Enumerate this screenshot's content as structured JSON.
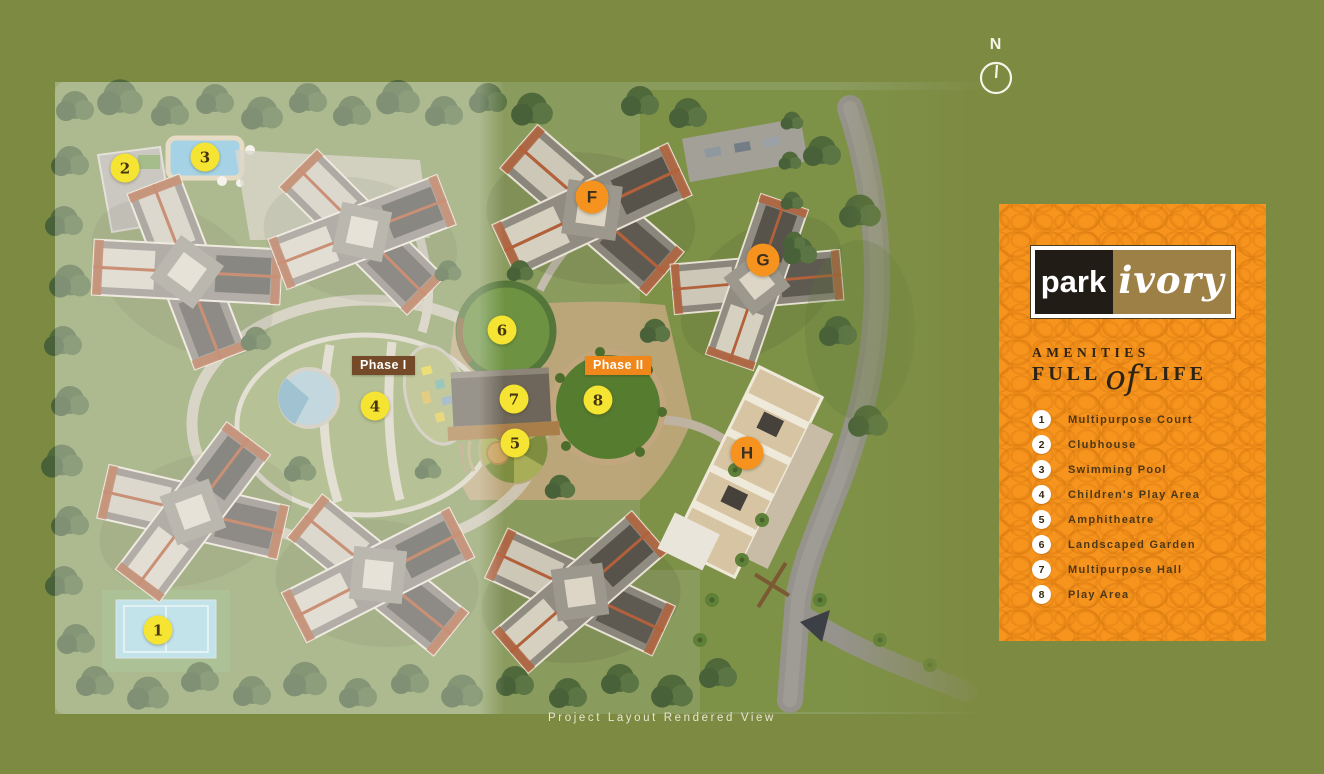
{
  "page": {
    "background": "#7d8a41",
    "caption": "Project Layout Rendered View"
  },
  "compass": {
    "label": "N"
  },
  "panel": {
    "background": "#f7941d",
    "logo": {
      "left_text": "park",
      "right_text": "ivory",
      "left_bg": "#221c17",
      "right_bg": "#9d8045"
    },
    "heading": {
      "line1": "AMENITIES",
      "line2_pre": "FULL",
      "line2_script": "of",
      "line2_post": "LIFE"
    },
    "amenities": [
      {
        "number": "1",
        "label": "Multipurpose Court"
      },
      {
        "number": "2",
        "label": "Clubhouse"
      },
      {
        "number": "3",
        "label": "Swimming Pool"
      },
      {
        "number": "4",
        "label": "Children's Play Area"
      },
      {
        "number": "5",
        "label": "Amphitheatre"
      },
      {
        "number": "6",
        "label": "Landscaped Garden"
      },
      {
        "number": "7",
        "label": "Multipurpose Hall"
      },
      {
        "number": "8",
        "label": "Play Area"
      }
    ]
  },
  "map": {
    "marker_colors": {
      "amenity_bg": "#f5e431",
      "building_bg": "#f6921e"
    },
    "phase_labels": [
      {
        "text": "Phase I",
        "x": 352,
        "y": 356,
        "color": "#744a28"
      },
      {
        "text": "Phase II",
        "x": 585,
        "y": 356,
        "color": "#f0871a"
      }
    ],
    "amenity_markers": [
      {
        "number": "1",
        "x": 158,
        "y": 630
      },
      {
        "number": "2",
        "x": 125,
        "y": 168
      },
      {
        "number": "3",
        "x": 205,
        "y": 157
      },
      {
        "number": "4",
        "x": 375,
        "y": 406
      },
      {
        "number": "5",
        "x": 515,
        "y": 443
      },
      {
        "number": "6",
        "x": 502,
        "y": 330
      },
      {
        "number": "7",
        "x": 514,
        "y": 399
      },
      {
        "number": "8",
        "x": 598,
        "y": 400
      }
    ],
    "building_markers": [
      {
        "letter": "F",
        "x": 592,
        "y": 197
      },
      {
        "letter": "G",
        "x": 763,
        "y": 260
      },
      {
        "letter": "H",
        "x": 747,
        "y": 453
      }
    ]
  }
}
